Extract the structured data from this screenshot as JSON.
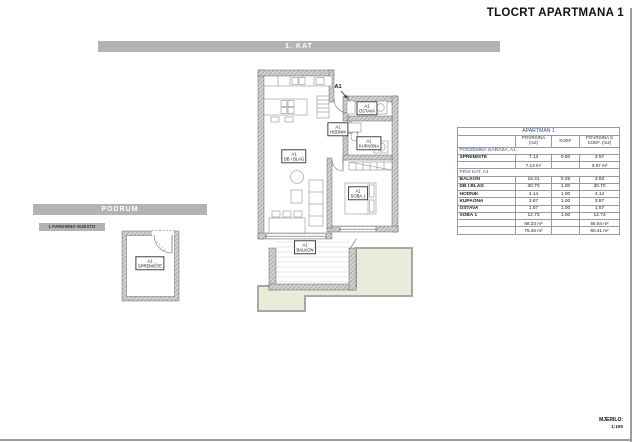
{
  "sheet": {
    "title": "TLOCRT APARTMANA 1",
    "scale_label": "MJERILO:",
    "scale_value": "1:100"
  },
  "sections": {
    "first_floor": "1. KAT",
    "basement": "PODRUM",
    "parking": "1 PARKIRNO MJESTO"
  },
  "plan_labels": {
    "entry": "A1",
    "hodnik": {
      "unit": "A1",
      "name": "HODNIK"
    },
    "ostava": {
      "unit": "A1",
      "name": "OSTAVA"
    },
    "kupaona": {
      "unit": "A1",
      "name": "KUPAONA"
    },
    "soba": {
      "unit": "A1",
      "name": "SOBA 1"
    },
    "dnevni": {
      "unit": "A1",
      "name": "DB I BLAG"
    },
    "balkon": {
      "unit": "A1",
      "name": "BALKON"
    },
    "spremiste": {
      "unit": "A1",
      "name": "SPREMIŠTE"
    }
  },
  "table": {
    "title": "APARTMAN 1",
    "columns": [
      "POVRŠINA (m2)",
      "KOEF",
      "POVRŠINA S KOEF. (m2)"
    ],
    "sections": [
      {
        "name": "PODZEMNA GARAŽA, A1",
        "rows": [
          {
            "name": "SPREMIŠTE",
            "area": "7.13",
            "koef": "0.50",
            "area_koef": "3.57"
          }
        ],
        "subtotal": {
          "area": "7.13 m²",
          "area_koef": "3.57 m²"
        }
      },
      {
        "name": "PRVI KAT, A1",
        "rows": [
          {
            "name": "BALKON",
            "area": "15.31",
            "koef": "0.25",
            "area_koef": "3.83"
          },
          {
            "name": "DB I BLAG",
            "area": "30.70",
            "koef": "1.00",
            "area_koef": "30.70"
          },
          {
            "name": "HODNIK",
            "area": "4.14",
            "koef": "1.00",
            "area_koef": "4.14"
          },
          {
            "name": "KUPAONA",
            "area": "3.87",
            "koef": "1.00",
            "area_koef": "3.87"
          },
          {
            "name": "OSTAVA",
            "area": "1.57",
            "koef": "1.00",
            "area_koef": "1.57"
          },
          {
            "name": "SOBA 1",
            "area": "12.73",
            "koef": "1.00",
            "area_koef": "12.73"
          }
        ],
        "subtotal": {
          "area": "68.33 m²",
          "area_koef": "56.84 m²"
        }
      }
    ],
    "total": {
      "area": "75.46 m²",
      "area_koef": "60.41 m²"
    }
  },
  "colors": {
    "header_bar_gray": "#b3b3b3",
    "table_accent_blue": "#2d4f9e",
    "landscape_green": "#e8edd9"
  }
}
